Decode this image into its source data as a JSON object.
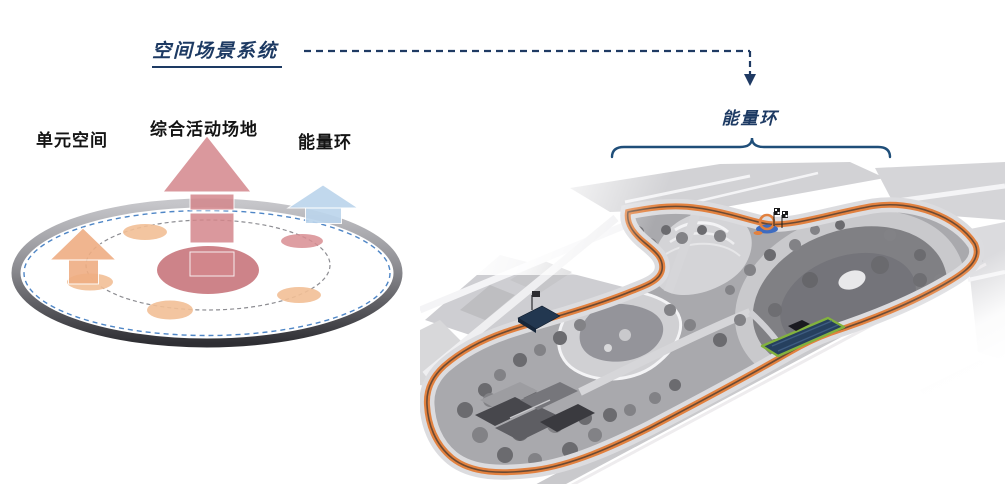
{
  "slide": {
    "title": "空间场景系统",
    "accent_navy": "#1d3a63"
  },
  "concept_diagram": {
    "labels": {
      "unit_space": "单元空间",
      "activity_ground": "综合活动场地",
      "energy_ring": "能量环"
    },
    "colors": {
      "unit_space_arrow": "#efae83",
      "activity_arrow": "#d4878c",
      "energy_ring_arrow": "#bcd5ec",
      "ring_band_top": "#c6c6ca",
      "ring_band_bottom": "#2e2e33",
      "ring_blue_dash": "#4f86c6",
      "center_node": "#c8767c",
      "satellite_node_orange": "#f2bf96",
      "satellite_node_pink": "#d88d92"
    }
  },
  "site_plan": {
    "callout_label": "能量环",
    "loop_color": "#e2813f",
    "highlight_green": "#82b23e",
    "highlight_navy": "#26405e"
  }
}
